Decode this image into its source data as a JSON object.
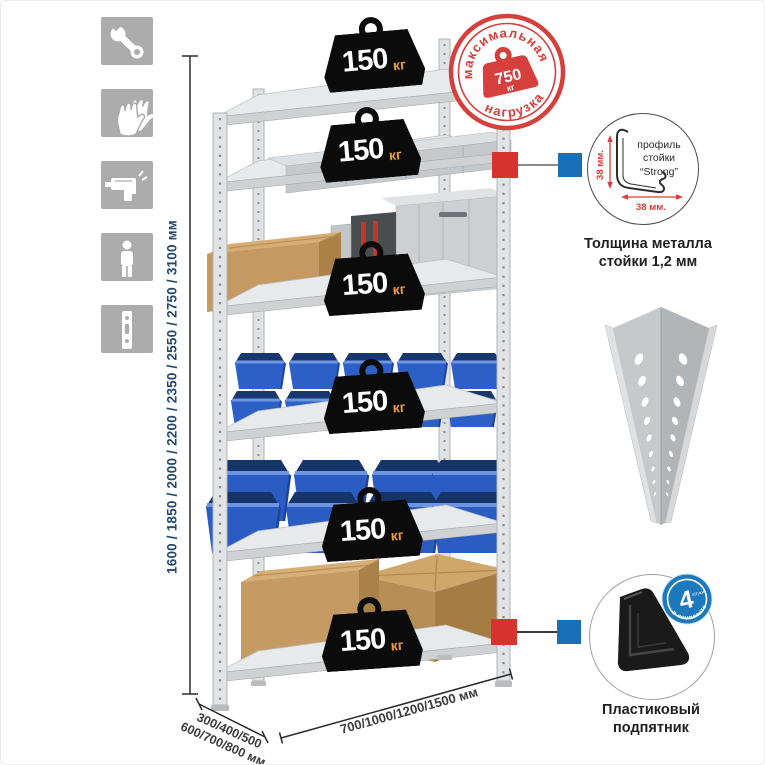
{
  "assembly_icons": {
    "items": [
      {
        "name": "wrench"
      },
      {
        "name": "gloves"
      },
      {
        "name": "drill"
      },
      {
        "name": "person"
      },
      {
        "name": "upright-profile"
      }
    ]
  },
  "dimensions": {
    "height": "1600 / 1850 / 2000 / 2200 / 2350 / 2550 / 2750 / 3100 мм",
    "depth_line1": "300/400/500",
    "depth_line2": "600/700/800 мм",
    "width": "700/1000/1200/1500 мм"
  },
  "rack": {
    "shelves": [
      {
        "load": "150",
        "unit": "кг"
      },
      {
        "load": "150",
        "unit": "кг"
      },
      {
        "load": "150",
        "unit": "кг"
      },
      {
        "load": "150",
        "unit": "кг"
      },
      {
        "load": "150",
        "unit": "кг"
      },
      {
        "load": "150",
        "unit": "кг"
      }
    ]
  },
  "max_load_stamp": {
    "arc_top": "максимальная",
    "arc_bottom": "нагрузка",
    "value": "750",
    "unit": "кг"
  },
  "profile_detail": {
    "line1": "профиль",
    "line2": "стойки",
    "line3": "“Strong”",
    "dim_vertical": "38 мм.",
    "dim_horizontal": "38 мм.",
    "caption_line1": "Толщина металла",
    "caption_line2": "стойки 1,2 мм"
  },
  "foot_detail": {
    "badge_value": "4",
    "badge_unit": "штуки",
    "badge_arc": "в комплекте",
    "caption_line1": "Пластиковый",
    "caption_line2": "подпятник"
  },
  "colors": {
    "accent_red": "#d6403c",
    "accent_blue": "#1a70b7",
    "bins_blue": "#2b5cc5",
    "cardboard": "#c49a62",
    "metal_gray": "#d9dbdd",
    "icon_gray": "#acacac",
    "dim_text_blue": "#21486f"
  }
}
